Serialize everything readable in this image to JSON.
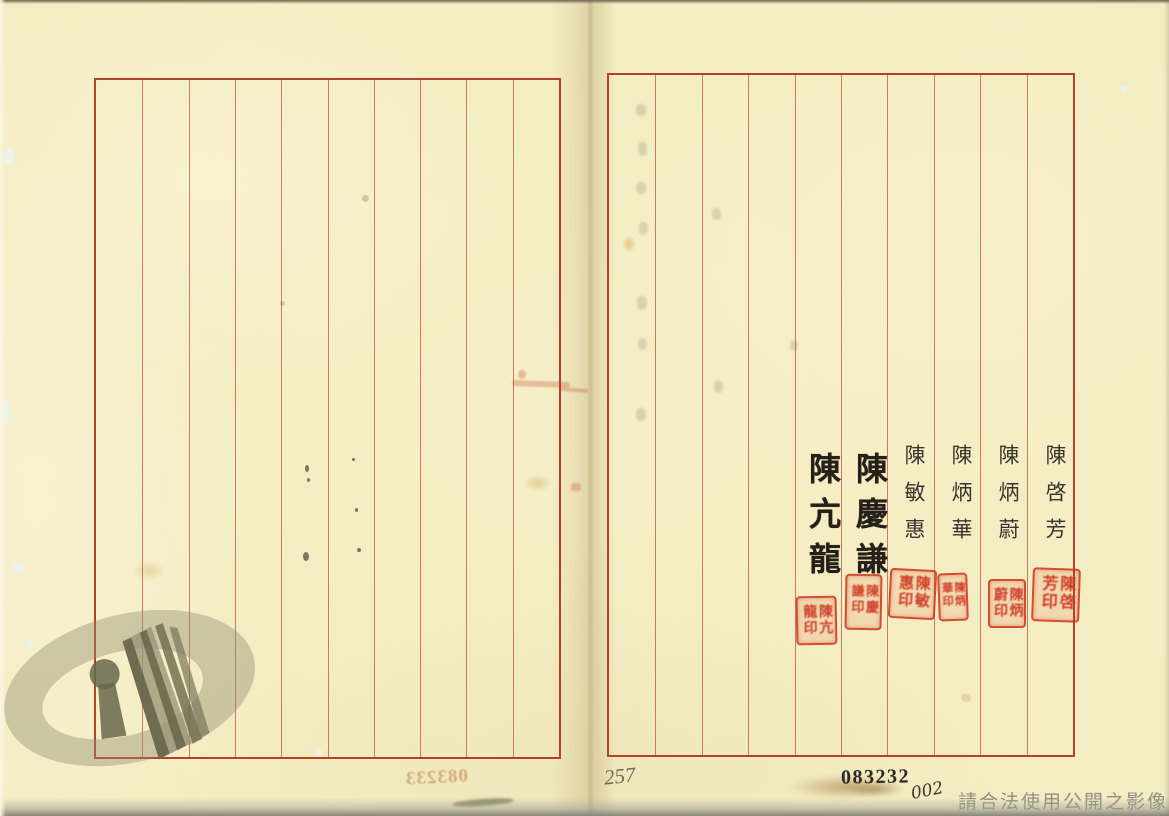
{
  "document": {
    "kind": "scanned two-page ruled archival register spread",
    "footer_notice": "請合法使用公開之影像",
    "archive_number": "083232",
    "copy_number": "002",
    "pencil_note": "257",
    "bleedthrough_number": "083233"
  },
  "pages": {
    "left": {
      "columns": 10
    },
    "right": {
      "columns": 10
    }
  },
  "signatures": [
    {
      "name": "陳啓芳",
      "script": "regular",
      "seal_text": "陳啓芳印"
    },
    {
      "name": "陳炳蔚",
      "script": "regular",
      "seal_text": "陳炳蔚印"
    },
    {
      "name": "陳炳華",
      "script": "regular",
      "seal_text": "陳炳華印"
    },
    {
      "name": "陳敏惠",
      "script": "regular",
      "seal_text": "陳敏惠印"
    },
    {
      "name": "陳慶謙",
      "script": "brush",
      "seal_text": "陳慶謙印"
    },
    {
      "name": "陳亢龍",
      "script": "brush",
      "seal_text": "陳亢龍印"
    }
  ],
  "watermark": {
    "icon": "archives-books-keyhole-logo"
  },
  "colors": {
    "paper": "#f5eec5",
    "page_border": "#b5402c",
    "column_line": "#bb5f46",
    "seal_red": "#cf3d26",
    "ink": "#38332b",
    "watermark_light": "#a8a483",
    "watermark_dark": "#6f6d50",
    "footer_text": "#8f8f85",
    "stamp_ink": "#2c2a24"
  }
}
